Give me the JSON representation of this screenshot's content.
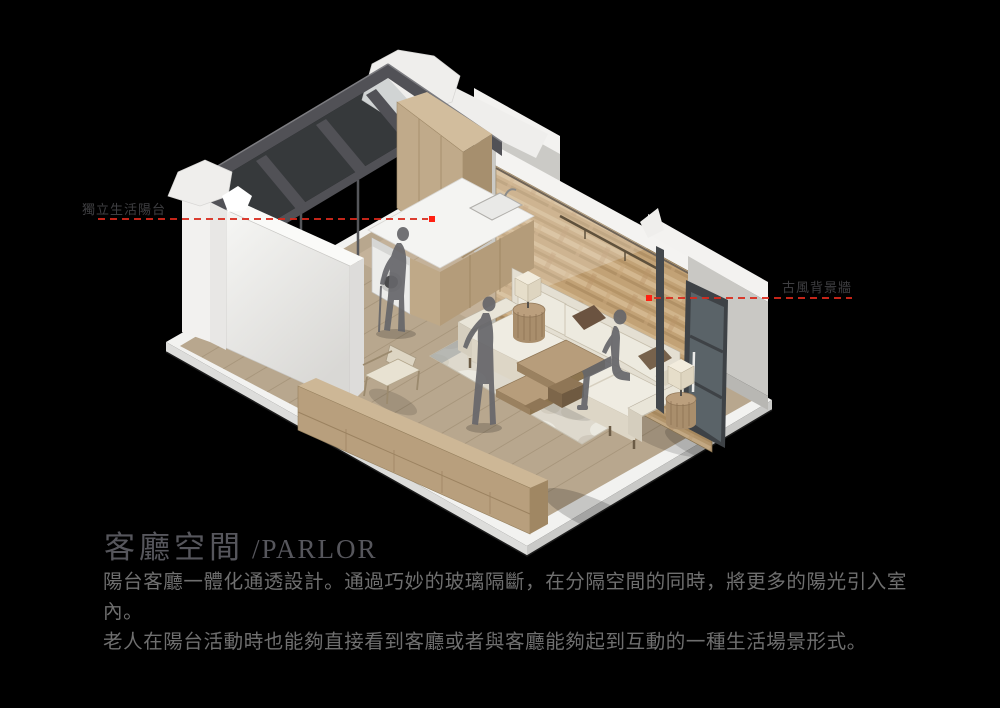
{
  "colors": {
    "background": "#000000",
    "annotation_red": "#d92a1c",
    "annotation_dot": "#ff2012",
    "annotation_label": "#3f3f42",
    "title": "#56565c",
    "body_text": "#6f6f6f",
    "slab": "#f2f2f0",
    "wall_white": "#efeeec",
    "wall_gray": "#cbcac6",
    "beam": "#515156",
    "glass": "#9aa4a8",
    "floor_wood": "#b8a78e",
    "balcony_wood": "#c4b29a",
    "plank_line": "#a29076",
    "feature_wall": "#c2a276",
    "cabinet_wood": "#c0aa8a",
    "sofa": "#efece2",
    "rug": "#ded9cd",
    "figure": "#66666a",
    "door_frame": "#3e4246"
  },
  "annotations": {
    "left": {
      "label": "獨立生活陽台"
    },
    "right": {
      "label": "古風背景牆"
    }
  },
  "title": {
    "zh": "客廳空間",
    "en": "/PARLOR"
  },
  "description": {
    "line1": "陽台客廳一體化通透設計。通過巧妙的玻璃隔斷，在分隔空間的同時，將更多的陽光引入室內。",
    "line2": "老人在陽台活動時也能夠直接看到客廳或者與客廳能夠起到互動的一種生活場景形式。"
  }
}
